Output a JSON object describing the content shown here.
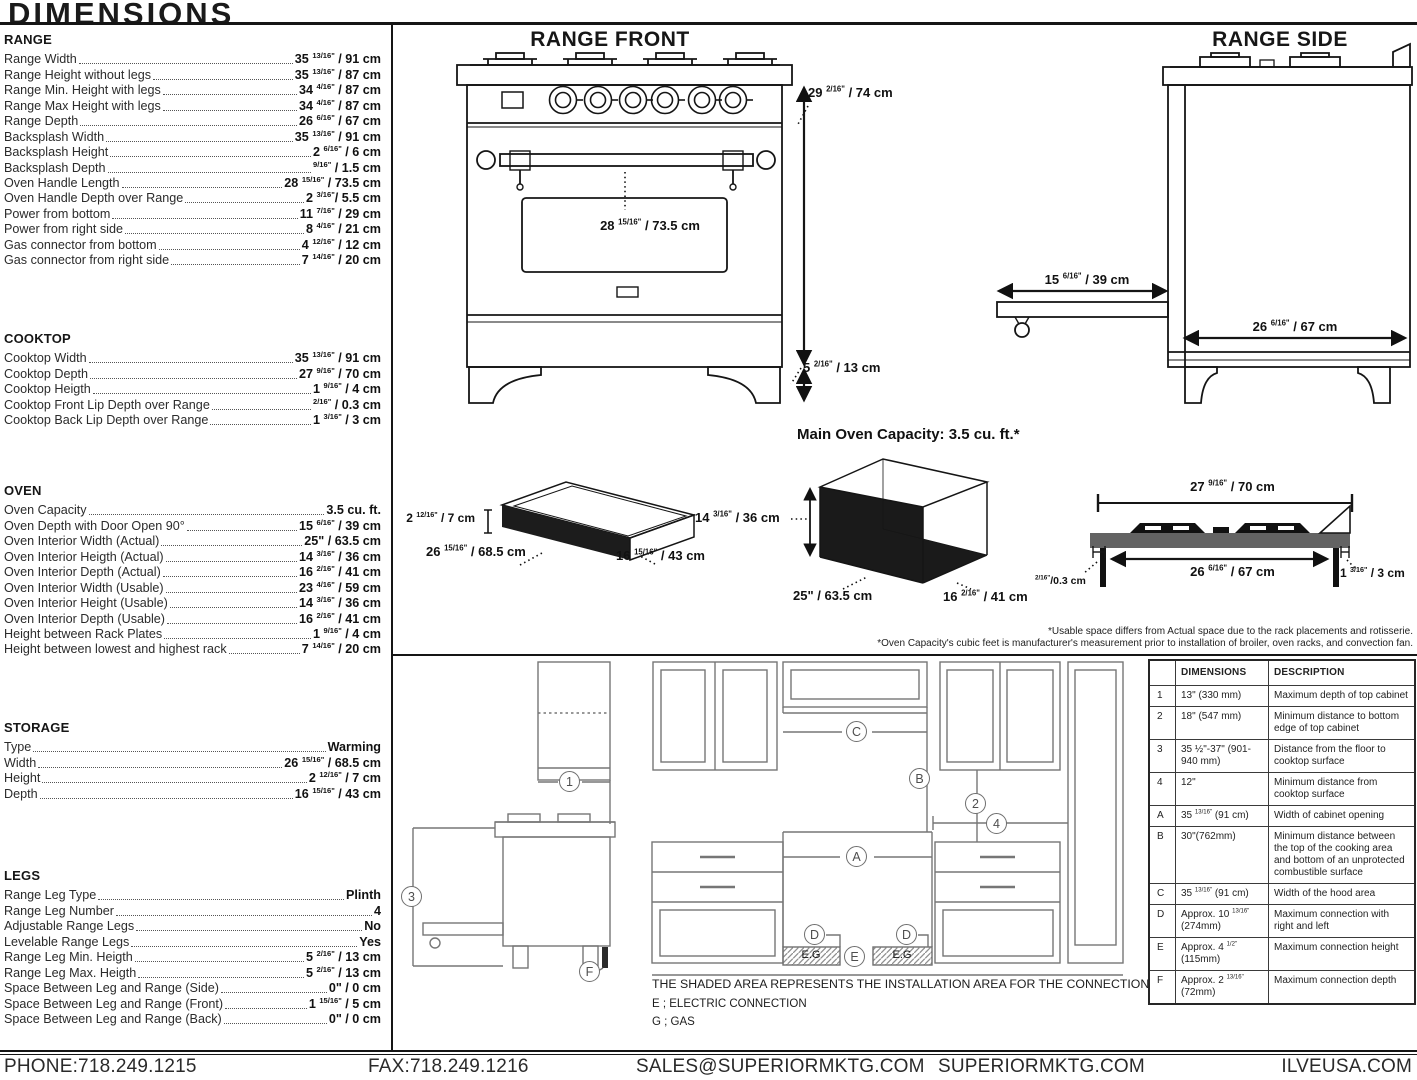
{
  "page": {
    "title": "DIMENSIONS"
  },
  "specs": {
    "sections": [
      {
        "title": "RANGE",
        "rows": [
          {
            "label": "Range Width",
            "value": "35 13/16\" / 91 cm"
          },
          {
            "label": "Range Height without legs",
            "value": "35 13/16\" / 87 cm"
          },
          {
            "label": "Range Min. Height with legs",
            "value": "34 4/16\" / 87 cm"
          },
          {
            "label": "Range Max Height with legs",
            "value": "34 4/16\" / 87 cm"
          },
          {
            "label": "Range Depth",
            "value": "26 6/16\" / 67 cm"
          },
          {
            "label": "Backsplash Width",
            "value": "35 13/16\" / 91 cm"
          },
          {
            "label": "Backsplash Height",
            "value": "2 6/16\" / 6 cm"
          },
          {
            "label": "Backsplash Depth",
            "value": "9/16\" / 1.5 cm"
          },
          {
            "label": "Oven Handle Length",
            "value": "28 15/16\" / 73.5 cm"
          },
          {
            "label": "Oven Handle Depth over Range",
            "value": "2 3/16\"/ 5.5 cm"
          },
          {
            "label": "Power from bottom",
            "value": "11 7/16\" / 29 cm"
          },
          {
            "label": "Power from right side",
            "value": "8 4/16\" / 21 cm"
          },
          {
            "label": "Gas connector from bottom",
            "value": "4 12/16\" / 12 cm"
          },
          {
            "label": "Gas connector from right side",
            "value": "7 14/16\" / 20 cm"
          }
        ]
      },
      {
        "title": "COOKTOP",
        "rows": [
          {
            "label": "Cooktop Width",
            "value": "35 13/16\" / 91 cm"
          },
          {
            "label": "Cooktop Depth",
            "value": "27 9/16\" / 70 cm"
          },
          {
            "label": "Cooktop Heigth",
            "value": "1 9/16\" / 4 cm"
          },
          {
            "label": "Cooktop Front Lip Depth over Range",
            "value": "2/16\" / 0.3 cm"
          },
          {
            "label": "Cooktop Back Lip Depth over Range",
            "value": "1 3/16\" / 3 cm"
          }
        ]
      },
      {
        "title": "OVEN",
        "rows": [
          {
            "label": "Oven Capacity",
            "value": "3.5 cu. ft."
          },
          {
            "label": "Oven Depth with Door Open 90°",
            "value": "15 6/16\" / 39 cm"
          },
          {
            "label": "Oven Interior Width (Actual)",
            "value": "25\" / 63.5 cm"
          },
          {
            "label": "Oven Interior Heigth (Actual)",
            "value": "14 3/16\" / 36 cm"
          },
          {
            "label": "Oven Interior Depth (Actual)",
            "value": "16 2/16\" / 41 cm"
          },
          {
            "label": "Oven Interior Width (Usable)",
            "value": "23 4/16\" / 59 cm"
          },
          {
            "label": "Oven Interior Height (Usable)",
            "value": "14 3/16\" / 36 cm"
          },
          {
            "label": "Oven Interior Depth (Usable)",
            "value": "16 2/16\" / 41 cm"
          },
          {
            "label": "Height between Rack Plates",
            "value": "1 9/16\" / 4 cm"
          },
          {
            "label": "Height between lowest and highest rack",
            "value": "7 14/16\" / 20 cm"
          }
        ]
      },
      {
        "title": "STORAGE",
        "rows": [
          {
            "label": "Type",
            "value": "Warming"
          },
          {
            "label": "Width",
            "value": "26 15/16\" / 68.5 cm"
          },
          {
            "label": "Height",
            "value": "2 12/16\" / 7 cm"
          },
          {
            "label": "Depth",
            "value": "16 15/16\" / 43 cm"
          }
        ]
      },
      {
        "title": "LEGS",
        "rows": [
          {
            "label": "Range Leg Type",
            "value": "Plinth"
          },
          {
            "label": "Range Leg Number",
            "value": "4"
          },
          {
            "label": "Adjustable Range Legs",
            "value": "No"
          },
          {
            "label": "Levelable Range Legs",
            "value": "Yes"
          },
          {
            "label": "Range Leg Min. Heigth",
            "value": "5 2/16\" / 13 cm"
          },
          {
            "label": "Range Leg Max. Heigth",
            "value": "5 2/16\" / 13 cm"
          },
          {
            "label": "Space Between Leg and Range (Side)",
            "value": "0\" / 0 cm"
          },
          {
            "label": "Space Between Leg and Range (Front)",
            "value": "1 15/16\" / 5 cm"
          },
          {
            "label": "Space Between Leg and Range (Back)",
            "value": "0\" / 0 cm"
          }
        ]
      }
    ]
  },
  "diagrams": {
    "front": {
      "title": "RANGE FRONT",
      "height": "29 2/16\" / 74 cm",
      "legs": "5 2/16\" / 13 cm",
      "handle": "28 15/16\" / 73.5 cm"
    },
    "side": {
      "title": "RANGE SIDE",
      "door_open": "15 6/16\" / 39 cm",
      "depth": "26 6/16\" / 67 cm"
    },
    "drawer": {
      "height": "2 12/16\" / 7 cm",
      "width": "26 15/16\" / 68.5 cm",
      "depth": "16 15/16\" / 43 cm"
    },
    "oven_box": {
      "title": "Main Oven Capacity: 3.5 cu. ft.*",
      "height": "14 3/16\" / 36 cm",
      "width": "25\" / 63.5 cm",
      "depth": "16 2/16\" / 41 cm"
    },
    "cooktop_profile": {
      "width_overall": "27 9/16\" / 70 cm",
      "width_body": "26 6/16\" / 67 cm",
      "front_lip": "2/16\"/0.3 cm",
      "back_lip": "1 3/16\" / 3 cm"
    },
    "footnotes": [
      "*Usable space differs from Actual space due to the rack placements and rotisserie.",
      "*Oven Capacity's cubic feet is manufacturer's measurement prior to installation of broiler, oven racks, and convection fan."
    ]
  },
  "installation": {
    "note": "THE SHADED AREA REPRESENTS THE INSTALLATION AREA FOR THE CONNECTIONS;",
    "legend": [
      "E ; ELECTRIC CONNECTION",
      "G ; GAS"
    ],
    "shaded_label": "E.G",
    "callouts": {
      "n1": "1",
      "n2": "2",
      "n3": "3",
      "n4": "4",
      "a": "A",
      "b": "B",
      "c": "C",
      "d": "D",
      "e": "E",
      "f": "F"
    },
    "table": {
      "col_dimensions": "DIMENSIONS",
      "col_description": "DESCRIPTION",
      "rows": [
        {
          "id": "1",
          "dimension": "13\" (330 mm)",
          "description": "Maximum depth of top cabinet"
        },
        {
          "id": "2",
          "dimension": "18\" (547 mm)",
          "description": "Minimum distance to bottom edge of top cabinet"
        },
        {
          "id": "3",
          "dimension": "35 ½\"-37\" (901-940 mm)",
          "description": "Distance from the floor to cooktop surface"
        },
        {
          "id": "4",
          "dimension": "12\"",
          "description": "Minimum distance from cooktop surface"
        },
        {
          "id": "A",
          "dimension": "35 13/16\" (91 cm)",
          "description": "Width of cabinet opening"
        },
        {
          "id": "B",
          "dimension": "30\"(762mm)",
          "description": "Minimum distance between the top of the cooking area and bottom of an unprotected combustible surface"
        },
        {
          "id": "C",
          "dimension": "35 13/16\" (91 cm)",
          "description": "Width of the hood area"
        },
        {
          "id": "D",
          "dimension": "Approx. 10 13/16\" (274mm)",
          "description": "Maximum connection with right and left"
        },
        {
          "id": "E",
          "dimension": "Approx. 4 1/2\" (115mm)",
          "description": "Maximum connection height"
        },
        {
          "id": "F",
          "dimension": "Approx. 2 13/16\" (72mm)",
          "description": "Maximum connection depth"
        }
      ]
    }
  },
  "footer": {
    "phone": "PHONE:718.249.1215",
    "fax": "FAX:718.249.1216",
    "email": "SALES@SUPERIORMKTG.COM",
    "website": "SUPERIORMKTG.COM",
    "website2": "ILVEUSA.COM"
  },
  "colors": {
    "line": "#151515",
    "install_line": "#767676",
    "slab_gray": "#636363"
  }
}
